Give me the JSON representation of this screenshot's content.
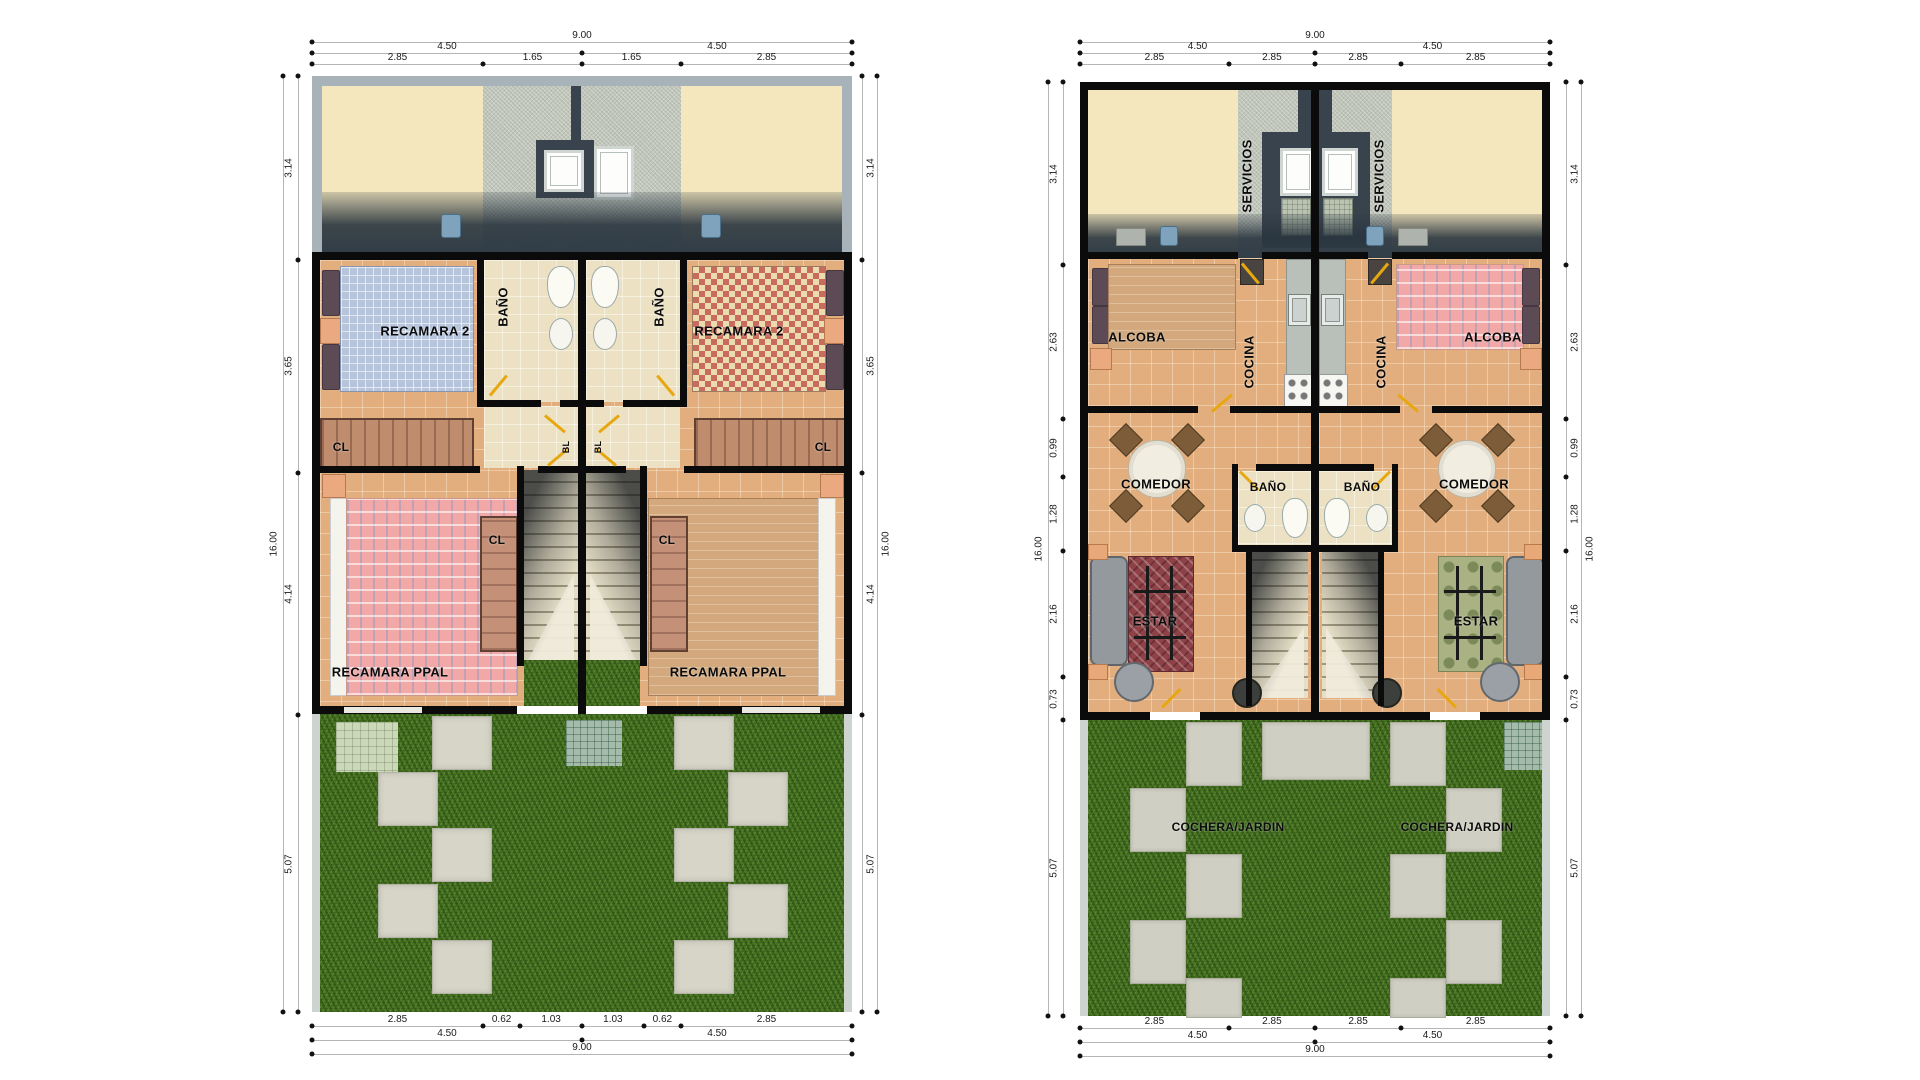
{
  "left_plan": {
    "name": "planta alta duplex",
    "rooms": {
      "recamara2": "RECAMARA 2",
      "bano": "BAÑO",
      "cl": "CL",
      "bl": "BL",
      "recamara_ppal": "RECAMARA PPAL"
    },
    "top_rows": [
      [
        {
          "t": "9.00",
          "a": 0,
          "b": 9
        }
      ],
      [
        {
          "t": "4.50",
          "a": 0,
          "b": 4.5
        },
        {
          "t": "4.50",
          "a": 4.5,
          "b": 9
        }
      ],
      [
        {
          "t": "2.85",
          "a": 0,
          "b": 2.85
        },
        {
          "t": "1.65",
          "a": 2.85,
          "b": 4.5
        },
        {
          "t": "1.65",
          "a": 4.5,
          "b": 6.15
        },
        {
          "t": "2.85",
          "a": 6.15,
          "b": 9
        }
      ]
    ],
    "bottom_rows": [
      [
        {
          "t": "2.85",
          "a": 0,
          "b": 2.85
        },
        {
          "t": "0.62",
          "a": 2.85,
          "b": 3.47
        },
        {
          "t": "1.03",
          "a": 3.47,
          "b": 4.5
        },
        {
          "t": "1.03",
          "a": 4.5,
          "b": 5.53
        },
        {
          "t": "0.62",
          "a": 5.53,
          "b": 6.15
        },
        {
          "t": "2.85",
          "a": 6.15,
          "b": 9
        }
      ],
      [
        {
          "t": "4.50",
          "a": 0,
          "b": 4.5
        },
        {
          "t": "4.50",
          "a": 4.5,
          "b": 9
        }
      ],
      [
        {
          "t": "9.00",
          "a": 0,
          "b": 9
        }
      ]
    ],
    "side_segments": [
      {
        "t": "3.14",
        "a": 0,
        "b": 3.14
      },
      {
        "t": "3.65",
        "a": 3.14,
        "b": 6.79
      },
      {
        "t": "4.14",
        "a": 6.79,
        "b": 10.93
      },
      {
        "t": "5.07",
        "a": 10.93,
        "b": 16
      }
    ],
    "side_total": [
      {
        "t": "16.00",
        "a": 0,
        "b": 16
      }
    ]
  },
  "right_plan": {
    "name": "planta baja duplex",
    "rooms": {
      "servicios": "SERVICIOS",
      "alcoba": "ALCOBA",
      "cocina": "COCINA",
      "comedor": "COMEDOR",
      "bano": "BAÑO",
      "estar": "ESTAR",
      "cochera": "COCHERA/JARDIN"
    },
    "top_rows": [
      [
        {
          "t": "9.00",
          "a": 0,
          "b": 9
        }
      ],
      [
        {
          "t": "4.50",
          "a": 0,
          "b": 4.5
        },
        {
          "t": "4.50",
          "a": 4.5,
          "b": 9
        }
      ],
      [
        {
          "t": "2.85",
          "a": 0,
          "b": 2.85
        },
        {
          "t": "2.85",
          "a": 2.85,
          "b": 4.5
        },
        {
          "t": "2.85",
          "a": 4.5,
          "b": 6.15
        },
        {
          "t": "2.85",
          "a": 6.15,
          "b": 9
        }
      ]
    ],
    "bottom_rows": [
      [
        {
          "t": "2.85",
          "a": 0,
          "b": 2.85
        },
        {
          "t": "2.85",
          "a": 2.85,
          "b": 4.5
        },
        {
          "t": "2.85",
          "a": 4.5,
          "b": 6.15
        },
        {
          "t": "2.85",
          "a": 6.15,
          "b": 9
        }
      ],
      [
        {
          "t": "4.50",
          "a": 0,
          "b": 4.5
        },
        {
          "t": "4.50",
          "a": 4.5,
          "b": 9
        }
      ],
      [
        {
          "t": "9.00",
          "a": 0,
          "b": 9
        }
      ]
    ],
    "side_segments": [
      {
        "t": "3.14",
        "a": 0,
        "b": 3.14
      },
      {
        "t": "2.63",
        "a": 3.14,
        "b": 5.77
      },
      {
        "t": "0.99",
        "a": 5.77,
        "b": 6.76
      },
      {
        "t": "1.28",
        "a": 6.76,
        "b": 8.04
      },
      {
        "t": "2.16",
        "a": 8.04,
        "b": 10.2
      },
      {
        "t": "0.73",
        "a": 10.2,
        "b": 10.93
      },
      {
        "t": "5.07",
        "a": 10.93,
        "b": 16
      }
    ],
    "side_total": [
      {
        "t": "16.00",
        "a": 0,
        "b": 16
      }
    ]
  },
  "colors": {
    "wall": "#0b0b0b",
    "floor_tile": "#e2ae7e",
    "grass": "#477322",
    "roof_cream": "#f4e6bd",
    "concrete": "#c0c5ba",
    "door_accent": "#e7a70f"
  }
}
